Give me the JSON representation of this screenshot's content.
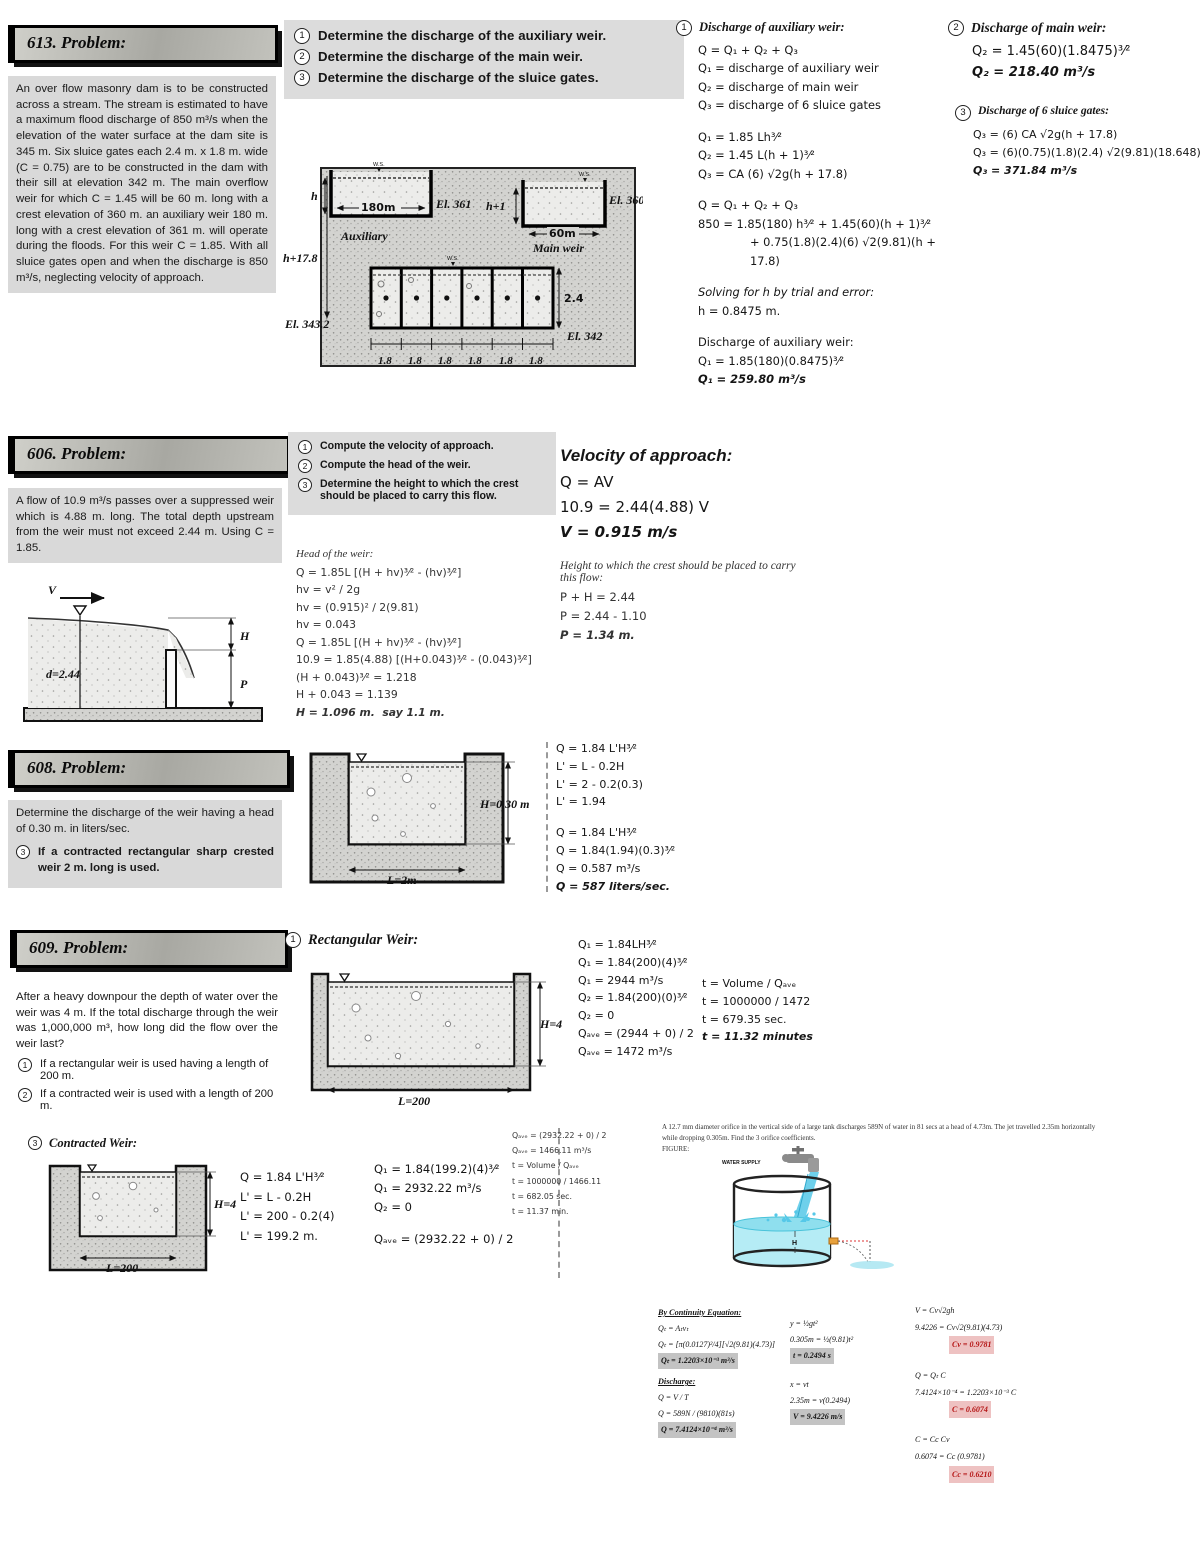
{
  "p613": {
    "banner": "613. Problem:",
    "statement": "An over flow masonry dam is to be constructed across a stream.  The stream is estimated to have a maximum flood discharge of 850 m³/s when the elevation of the water surface at the dam site is 345 m.  Six sluice gates each 2.4 m. x 1.8 m. wide (C = 0.75) are to be constructed in the dam with their sill at elevation 342 m.  The main overflow weir for which C = 1.45 will be 60 m. long with a crest elevation of 360 m.  an auxiliary weir 180 m. long with a crest elevation of 361 m. will operate during the floods.  For this weir C = 1.85.  With all sluice gates open and when the discharge is 850 m³/s, neglecting velocity of approach.",
    "questions": [
      {
        "n": "1",
        "t": "Determine the discharge of the auxiliary weir."
      },
      {
        "n": "2",
        "t": "Determine the discharge of the main weir."
      },
      {
        "n": "3",
        "t": "Determine the discharge of the sluice gates."
      }
    ],
    "diagram": {
      "ws1": "W.S.",
      "ws2": "W.S.",
      "ws3": "W.S.",
      "h": "h",
      "el361": "El. 361",
      "dim180": "180m",
      "auxiliary": "Auxiliary",
      "h1": "h+1",
      "dim60": "60m",
      "el360": "El. 360",
      "mainweir": "Main weir",
      "h178": "h+17.8",
      "el3432": "El. 343.2",
      "dim24": "2.4",
      "el342": "El. 342",
      "g18": [
        "1.8",
        "1.8",
        "1.8",
        "1.8",
        "1.8",
        "1.8"
      ]
    },
    "sol1": {
      "n": "1",
      "heading": "Discharge of auxiliary weir:",
      "lines": [
        "Q = Q₁ + Q₂ + Q₃",
        "Q₁ = discharge of auxiliary weir",
        "Q₂ = discharge of main weir",
        "Q₃ = discharge of 6 sluice gates",
        {
          "t": "Q₁ = 1.85 Lh³⁄²",
          "c": "gap"
        },
        "Q₂ = 1.45 L(h + 1)³⁄²",
        "Q₃ = CA (6) √2g(h + 17.8)",
        {
          "t": "Q = Q₁ + Q₂ + Q₃",
          "c": "gap"
        },
        "850 = 1.85(180) h³⁄² + 1.45(60)(h + 1)³⁄²",
        {
          "t": "+ 0.75(1.8)(2.4)(6) √2(9.81)(h + 17.8)",
          "c": "ind"
        },
        {
          "t": "Solving for h by trial and error:",
          "c": "gap it"
        },
        "h = 0.8475 m.",
        {
          "t": "Discharge of auxiliary weir:",
          "c": "gap"
        },
        "Q₁ = 1.85(180)(0.8475)³⁄²",
        {
          "t": "Q₁ = 259.80 m³/s",
          "c": "b"
        }
      ]
    },
    "sol2": {
      "n": "2",
      "heading": "Discharge of main weir:",
      "lines": [
        "Q₂ = 1.45(60)(1.8475)³⁄²",
        {
          "t": "Q₂ = 218.40 m³/s",
          "c": "b"
        }
      ]
    },
    "sol3": {
      "n": "3",
      "heading": "Discharge of 6 sluice gates:",
      "lines": [
        "Q₃ = (6) CA √2g(h + 17.8)",
        "Q₃ = (6)(0.75)(1.8)(2.4) √2(9.81)(18.648)",
        {
          "t": "Q₃ = 371.84 m³/s",
          "c": "b"
        }
      ]
    }
  },
  "p606": {
    "banner": "606. Problem:",
    "statement": "A flow of 10.9 m³/s passes over a suppressed weir which is 4.88 m. long.  The total depth upstream from the weir must not exceed 2.44 m.  Using C = 1.85.",
    "questions": [
      {
        "n": "1",
        "t": "Compute the velocity of approach."
      },
      {
        "n": "2",
        "t": "Compute the head of the weir."
      },
      {
        "n": "3",
        "t": "Determine the height to which the crest should be placed to carry this flow."
      }
    ],
    "diagram": {
      "v": "V",
      "d": "d=2.44",
      "H": "H",
      "P": "P"
    },
    "solMid": {
      "heading": "Head of the weir:",
      "lines": [
        "Q = 1.85L [(H + hv)³⁄² - (hv)³⁄²]",
        "hv = v² / 2g",
        "hv = (0.915)² / 2(9.81)",
        "hv = 0.043",
        "Q = 1.85L [(H + hv)³⁄² - (hv)³⁄²]",
        "10.9 = 1.85(4.88) [(H+0.043)³⁄² - (0.043)³⁄²]",
        "(H + 0.043)³⁄² = 1.218",
        "H + 0.043 = 1.139",
        {
          "t": "H = 1.096 m.  say 1.1 m.",
          "c": "b"
        }
      ]
    },
    "solRight": {
      "heading1": "Velocity of approach:",
      "lines1": [
        "Q = AV",
        "10.9 = 2.44(4.88) V",
        {
          "t": "V = 0.915 m/s",
          "c": "b"
        }
      ],
      "heading2": "Height to which the crest should be placed to carry this flow:",
      "lines2": [
        "P + H = 2.44",
        "P = 2.44 - 1.10",
        {
          "t": "P = 1.34 m.",
          "c": "b"
        }
      ]
    }
  },
  "p608": {
    "banner": "608. Problem:",
    "statement": "Determine the discharge of the weir having a head of 0.30 m. in liters/sec.",
    "sub": {
      "n": "3",
      "t": "If a contracted rectangular sharp crested weir 2 m. long is used."
    },
    "diagram": {
      "H": "H=0.30 m",
      "L": "L=2m"
    },
    "sol": {
      "lines": [
        "Q = 1.84 L'H³⁄²",
        "L' = L - 0.2H",
        "L' = 2 - 0.2(0.3)",
        "L' = 1.94",
        {
          "t": "Q = 1.84 L'H³⁄²",
          "c": "gap"
        },
        "Q = 1.84(1.94)(0.3)³⁄²",
        "Q = 0.587 m³/s",
        {
          "t": "Q = 587 liters/sec.",
          "c": "b"
        }
      ]
    }
  },
  "p609": {
    "banner": "609. Problem:",
    "statement": "After a heavy downpour the depth of water over the weir was 4 m.  If the total discharge through the weir was 1,000,000 m³, how long did the flow over the weir last?",
    "questions": [
      {
        "n": "1",
        "t": "If a rectangular weir is used having a length of 200 m."
      },
      {
        "n": "2",
        "t": "If a contracted weir is used with a length of 200 m."
      }
    ],
    "rectHeading": {
      "n": "1",
      "t": "Rectangular Weir:"
    },
    "diagram1": {
      "H": "H=4",
      "L": "L=200"
    },
    "solA": {
      "lines": [
        "Q₁ = 1.84LH³⁄²",
        "Q₁ = 1.84(200)(4)³⁄²",
        "Q₁ = 2944 m³/s",
        "Q₂ = 1.84(200)(0)³⁄²",
        "Q₂ = 0",
        "Qₐᵥₑ = (2944 + 0) / 2",
        "Qₐᵥₑ = 1472 m³/s"
      ]
    },
    "solB": {
      "lines": [
        "t = Volume / Qₐᵥₑ",
        "t = 1000000 / 1472",
        "t = 679.35 sec.",
        {
          "t": "t = 11.32 minutes",
          "c": "b"
        }
      ]
    },
    "contractedHeading": {
      "n": "3",
      "t": "Contracted Weir:"
    },
    "diagram2": {
      "H": "H=4",
      "L": "L=200"
    },
    "solCA": {
      "lines": [
        "Q = 1.84 L'H³⁄²",
        "L' = L - 0.2H",
        "L' = 200 - 0.2(4)",
        "L' = 199.2 m."
      ]
    },
    "solCB": {
      "lines": [
        "Q₁ = 1.84(199.2)(4)³⁄²",
        "Q₁ = 2932.22 m³/s",
        "Q₂ = 0",
        {
          "t": "Qₐᵥₑ = (2932.22 + 0) / 2",
          "c": "gap"
        }
      ]
    },
    "solCC": {
      "lines": [
        "Qₐᵥₑ = (2932.22 + 0) / 2",
        "Qₐᵥₑ = 1466.11 m³/s",
        "t = Volume / Qₐᵥₑ",
        "t = 1000000 / 1466.11",
        "t = 682.05 sec.",
        "t = 11.37 min."
      ]
    }
  },
  "orifice": {
    "statement": "A 12.7 mm diameter orifice in the vertical side of a large tank discharges 589N of water in 81 secs at a head of 4.73m. The jet travelled 2.35m horizontally while dropping 0.305m. Find the 3 orifice coefficients.",
    "figureLabel": "FIGURE:",
    "tank": {
      "supply": "WATER SUPPLY",
      "H": "H"
    },
    "col1": {
      "heading1": "By Continuity Equation:",
      "lines1": [
        "Qₜ = Aₜvₜ",
        "Qₜ = [π(0.0127)²/4][√2(9.81)(4.73)]",
        {
          "t": "Qₜ = 1.2203×10⁻³ m³/s",
          "c": "hl"
        }
      ],
      "heading2": "Discharge:",
      "lines2": [
        "Q = V / T",
        "Q = 589N / (9810)(81s)",
        {
          "t": "Q = 7.4124×10⁻⁴ m³/s",
          "c": "hl"
        }
      ]
    },
    "col2": {
      "lines": [
        "y = ½gt²",
        "0.305m = ½(9.81)t²",
        {
          "t": "t = 0.2494 s",
          "c": "hl"
        },
        {
          "t": "x = vt",
          "c": "gap"
        },
        "2.35m = v(0.2494)",
        {
          "t": "V = 9.4226 m/s",
          "c": "hl"
        }
      ]
    },
    "col3": {
      "lines": [
        "V = Cv√2gh",
        "9.4226 = Cv√2(9.81)(4.73)",
        {
          "t": "Cv = 0.9781",
          "c": "red"
        },
        {
          "t": "Q = Qₜ C",
          "c": "gap"
        },
        "7.4124×10⁻⁴ = 1.2203×10⁻³ C",
        {
          "t": "C = 0.6074",
          "c": "red"
        },
        {
          "t": "C = Cc Cv",
          "c": "gap"
        },
        "0.6074 = Cc (0.9781)",
        {
          "t": "Cc = 0.6210",
          "c": "red"
        }
      ]
    }
  }
}
